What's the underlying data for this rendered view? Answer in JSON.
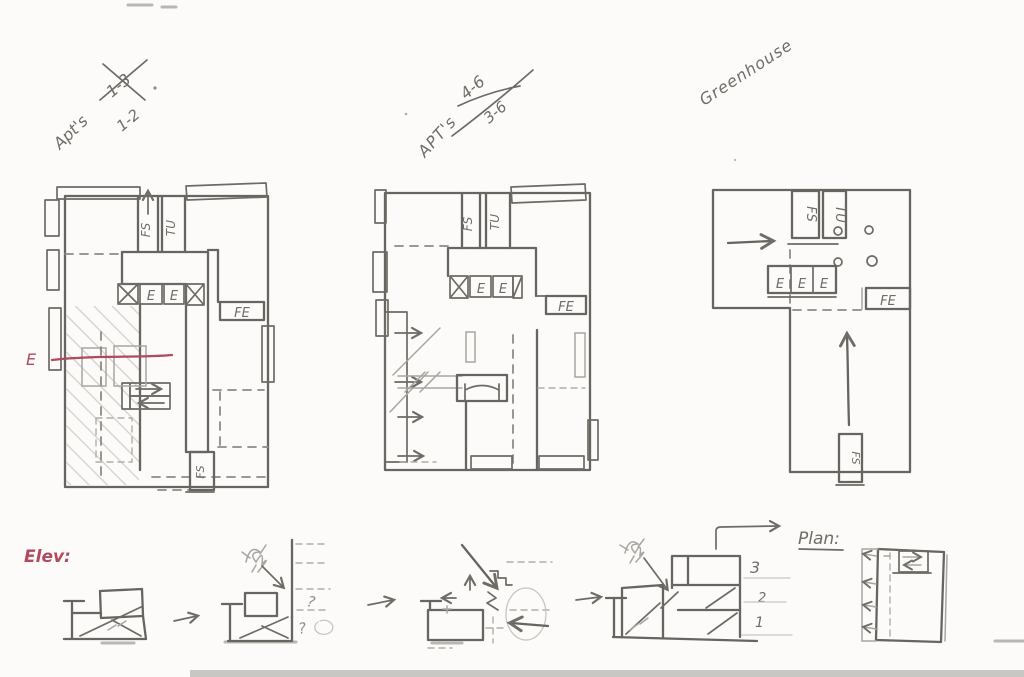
{
  "page": {
    "background": "#fcfbf9",
    "pencil_color": "#67655f",
    "annotation_red": "#b04a5c",
    "scan_strip_color": "#c9c7c3"
  },
  "plans": [
    {
      "title": "Apt's",
      "crossed_out": "1-3",
      "revised": "1-2",
      "stair_label_left": "FS",
      "stair_label_right": "TU",
      "elec_boxes": [
        "E",
        "E"
      ],
      "fire_equipment": "FE",
      "exit_stair": "FS"
    },
    {
      "title": "APT's",
      "crossed_out": "4-6",
      "revised": "3-6",
      "stair_label_left": "FS",
      "stair_label_right": "TU",
      "elec_boxes": [
        "E",
        "E"
      ],
      "fire_equipment": "FE"
    },
    {
      "title": "Greenhouse",
      "stair_label_left": "FS",
      "stair_label_right": "TU",
      "elec_boxes": [
        "E",
        "E",
        "E"
      ],
      "fire_equipment": "FE",
      "exit_stair": "FS"
    }
  ],
  "section_marker": {
    "label": "E"
  },
  "elevation_row": {
    "label": "Elev:",
    "question_marks": [
      "?",
      "?"
    ],
    "levels": [
      "3",
      "2",
      "1"
    ],
    "plan_label": "Plan:"
  }
}
